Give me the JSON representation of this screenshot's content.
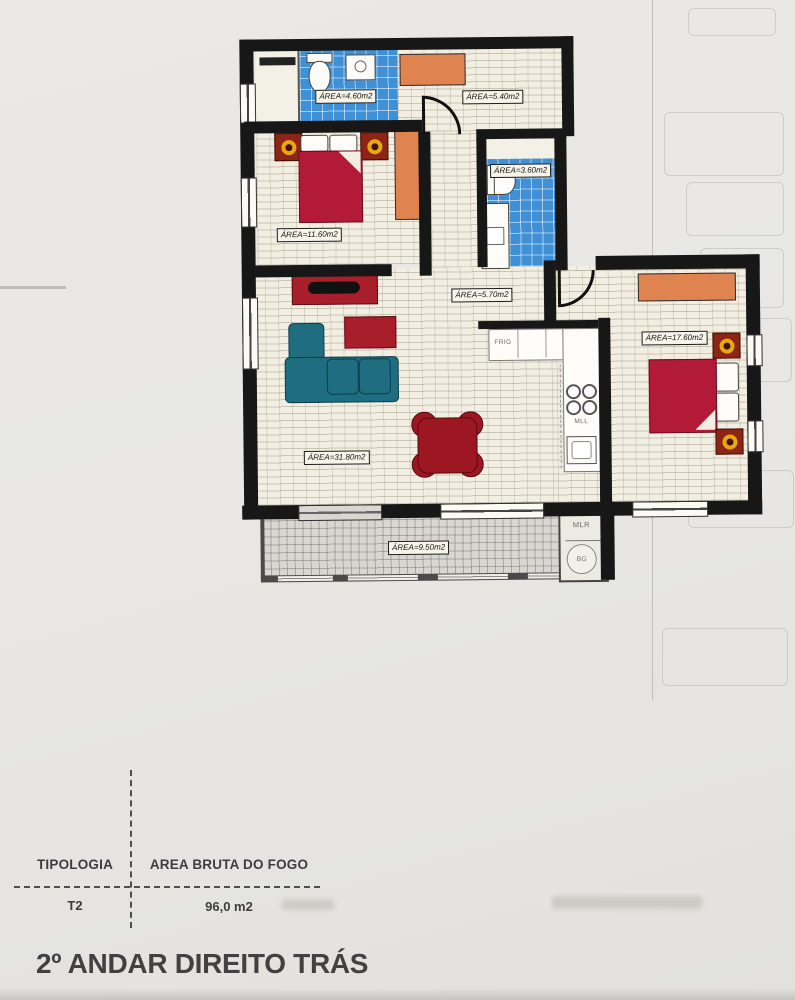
{
  "title": "2º ANDAR DIREITO TRÁS",
  "plan": {
    "labels": {
      "bathroom1": "ÁREA=4.60m2",
      "hall": "ÁREA=5.40m2",
      "bedroom1": "ÁREA=11.60m2",
      "bathroom2": "ÁREA=3.60m2",
      "hall2": "ÁREA=5.70m2",
      "bedroom2": "ÁREA=17.60m2",
      "living": "ÁREA=31.80m2",
      "balcony": "ÁREA=9.50m2"
    },
    "kitchen": {
      "fridge": "FRIG",
      "dishwasher": "MLL"
    },
    "laundry": {
      "washer": "MLR",
      "boiler": "BG"
    }
  },
  "summary_table": {
    "columns": [
      {
        "header": "TIPOLOGIA",
        "value": "T2"
      },
      {
        "header": "AREA BRUTA DO FOGO",
        "value": "96,0 m2"
      }
    ]
  },
  "colors": {
    "tile_blue": "#3f90d4",
    "bed_red": "#b31a38",
    "wood_orange": "#df8350",
    "sofa_teal": "#1f6d80",
    "lamp_gold": "#e9a70c",
    "dining_red": "#9d1722",
    "wall_black": "#171717"
  }
}
